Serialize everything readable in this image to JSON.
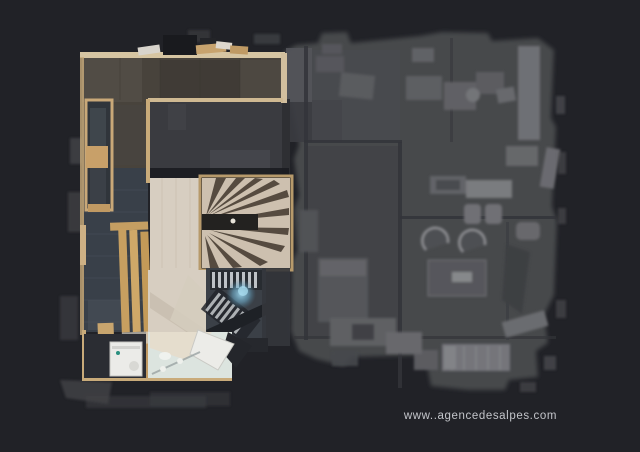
{
  "canvas": {
    "width": 640,
    "height": 452,
    "background_color": "#212227"
  },
  "watermark": {
    "text": "www..agencedesalpes.com",
    "color": "#c3c5ca"
  },
  "floorplan": {
    "view": "top-down-3d-scan-floorplan",
    "palette": {
      "ghost_base": "#47484c",
      "ghost_wall": "#333439",
      "ghost_furniture": "#6b6c70",
      "corridor_floor": "#48433c",
      "hall_tile_floor": "#394049",
      "dark_room_floor": "#3a3b40",
      "wood_trim": "#c9ab7a",
      "bench_wood": "#c79f60",
      "stair_wood_light": "#cdc0af",
      "stair_tread_dark": "#463c31",
      "pale_wood_floor": "#d7cec1",
      "bathroom_floor": "#dce4df",
      "appliance_white": "#ebebe8",
      "stairwell_glow": "#8ecbe4"
    },
    "features": [
      "entry-corridor",
      "wall-cabinet",
      "wooden-bench",
      "winder-staircase",
      "dark-room",
      "stairwell-down",
      "glass-railing-glow",
      "bathroom",
      "washing-machine",
      "ghost-floor-rooms",
      "armchairs",
      "coffee-table",
      "bed",
      "wardrobe"
    ]
  }
}
